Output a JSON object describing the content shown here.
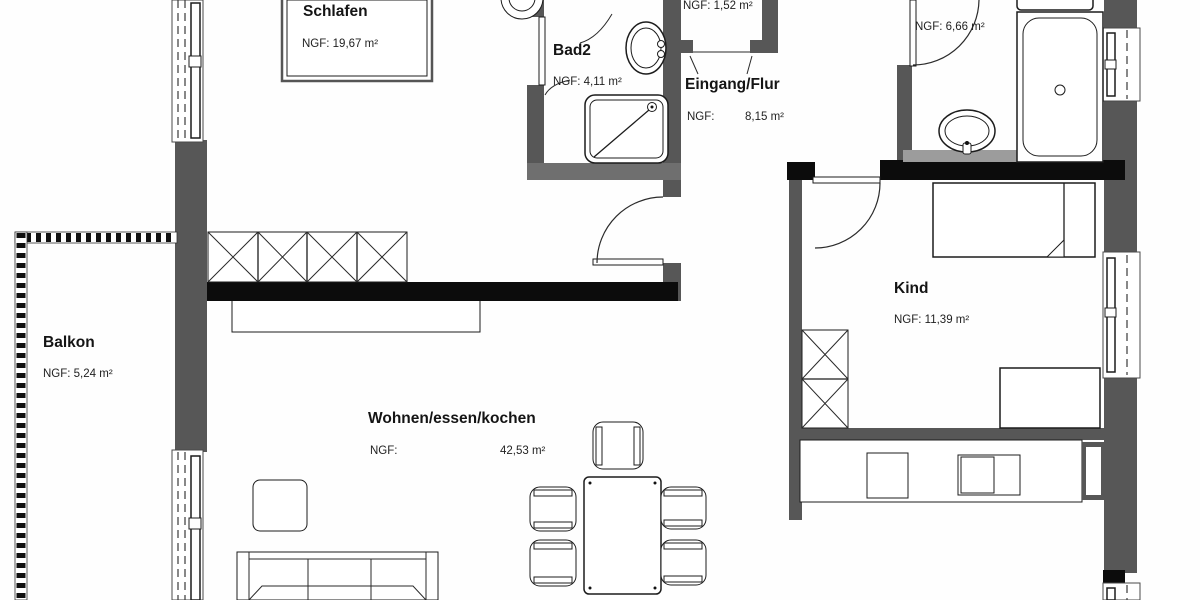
{
  "plan": {
    "title": "apartment-floor-plan",
    "rooms": {
      "schlafen": {
        "name": "Schlafen",
        "area": "NGF: 19,67 m²"
      },
      "bad2": {
        "name": "Bad2",
        "area": "NGF: 4,11 m²"
      },
      "abstell": {
        "area": "NGF: 1,52 m²"
      },
      "eingang": {
        "name": "Eingang/Flur",
        "area_label": "NGF:",
        "area_value": "8,15 m²"
      },
      "bad": {
        "area": "NGF: 6,66 m²"
      },
      "kind": {
        "name": "Kind",
        "area": "NGF: 11,39 m²"
      },
      "balkon": {
        "name": "Balkon",
        "area": "NGF: 5,24 m²"
      },
      "wohnen": {
        "name": "Wohnen/essen/kochen",
        "area_label": "NGF:",
        "area_value": "42,53 m²"
      }
    },
    "colors": {
      "wall_dark": "#575757",
      "wall_black": "#0c0c0c",
      "wall_medium": "#6f6f6f",
      "background": "#fefefe",
      "line": "#1c1c1c"
    }
  }
}
